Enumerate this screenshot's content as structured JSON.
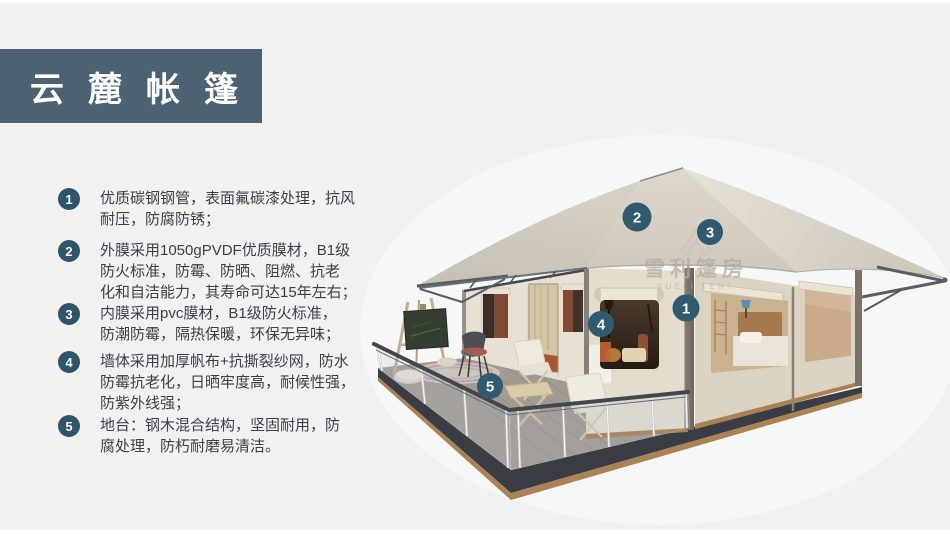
{
  "header": {
    "title": "云麓帐篷"
  },
  "features": [
    {
      "number": "1",
      "lines": [
        "优质碳钢钢管，表面氟碳漆处理，抗风",
        "耐压，防腐防锈；"
      ]
    },
    {
      "number": "2",
      "lines": [
        "外膜采用1050gPVDF优质膜材，B1级",
        "防火标准，防霉、防晒、阻燃、抗老",
        "化和自洁能力，其寿命可达15年左右；"
      ]
    },
    {
      "number": "3",
      "lines": [
        "内膜采用pvc膜材，B1级防火标准，",
        "防潮防霉，隔热保暖，环保无异味；"
      ]
    },
    {
      "number": "4",
      "lines": [
        "墙体采用加厚帆布+抗撕裂纱网，防水",
        "防霉抗老化，日晒牢度高，耐候性强，",
        "防紫外线强；"
      ]
    },
    {
      "number": "5",
      "lines": [
        "地台：钢木混合结构，坚固耐用，防",
        "腐处理，防朽耐磨易清洁。"
      ]
    }
  ],
  "diagram": {
    "watermark": {
      "cn": "雪利篷房",
      "en": "XUELI TENT",
      "logo": "tent-outline"
    },
    "markers": [
      {
        "number": "1",
        "x": 686,
        "y": 308,
        "r": 13.5
      },
      {
        "number": "2",
        "x": 637,
        "y": 217,
        "r": 14.5
      },
      {
        "number": "3",
        "x": 710,
        "y": 232,
        "r": 13
      },
      {
        "number": "4",
        "x": 601,
        "y": 324,
        "r": 13
      },
      {
        "number": "5",
        "x": 490,
        "y": 386,
        "r": 13
      }
    ]
  },
  "theme": {
    "page_bg": "#f1f1f2",
    "banner_bg": "#4c6172",
    "badge_bg": "#2d566a",
    "marker_bg": "#2f5a70",
    "text": "#3b4048",
    "roof": "#d7d0c5",
    "wall": "#e2dbcb",
    "deck_rim": "#3a3e44",
    "deck_floor": "#a39b92"
  }
}
